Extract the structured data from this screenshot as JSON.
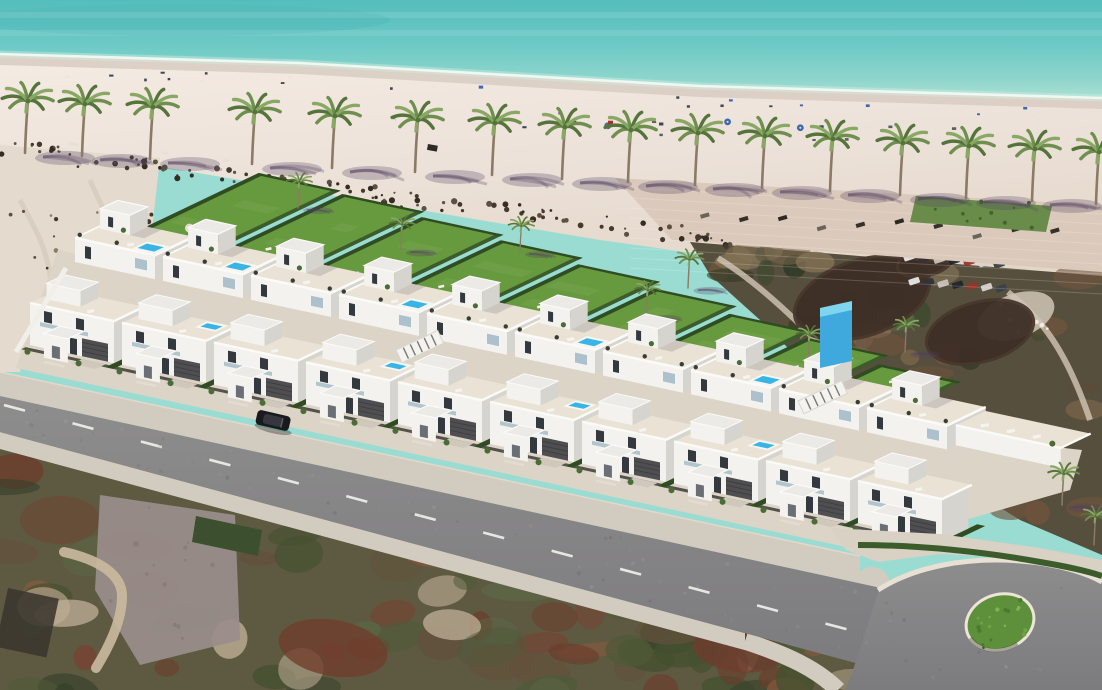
{
  "image": {
    "description": "Aerial 3D architectural rendering of a beachfront development: two rows of white modern villas with rooftop terraces and private garden pools, fronted by a palm-lined sandy beach and turquoise sea, with an asphalt road curving around a green traffic island below and undeveloped scrubland around",
    "width": 1102,
    "height": 690
  },
  "colors": {
    "sea_deep": "#55bdbc",
    "sea_mid": "#6cc9c5",
    "sea_shallow": "#8dd5cc",
    "sea_shore": "#abdfd3",
    "foam": "#f2f8f2",
    "foam_soft": "#cfeee3",
    "sand": "#ece1d8",
    "sand_light": "#f4ebe3",
    "sand_wet": "#d8cdc2",
    "sand_lot": "#e4dacd",
    "debris_dark": "#43392c",
    "debris_mid": "#5c5042",
    "debris_deep": "#352c22",
    "promenade": "#dbc9bc",
    "lawn_patch": "#6a8c4a",
    "lawn": "#67993f",
    "lawn_light": "#7aa953",
    "hedge": "#2f4c22",
    "hedge_light": "#3c5c2c",
    "pool": "#38b5e6",
    "pool_light": "#7fd4ee",
    "pool_rim": "#f6f6f3",
    "villa_white": "#f3f2ee",
    "villa_face2": "#eceae6",
    "villa_shade": "#d6d4cf",
    "terrace": "#e9e2d5",
    "parapet": "#fbfaf7",
    "window": "#34393f",
    "glass": "#9fb9c6",
    "garage": "#4f4f52",
    "fence": "#46443f",
    "blue_glass": "#3fa8dd",
    "road": "#868487",
    "road_line": "#efefec",
    "sidewalk": "#d2cbbf",
    "curb": "#e7e0d3",
    "apron": "#d8d1c4",
    "island_green": "#5e8f3a",
    "island_ring": "#ece5d8",
    "car": "#1a1a1e",
    "car_roof": "#36363e",
    "palm_leaf": "#6f8f4e",
    "palm_leaf_dark": "#55743b",
    "palm_leaf_light": "#8aa865",
    "palm_trunk": "#8a7a66",
    "shadow": "rgba(82,64,96,0.28)",
    "umbrella_blue": "#3f69ad",
    "speck_dark": "#3e4854",
    "speck_white": "#e8e6e0",
    "speck_red": "#a83428",
    "dirt_mauve": "#9a8e8c",
    "path_sand": "#c9b99d",
    "thatch": "#3e2f26",
    "thatch2": "#49372c",
    "dev_ground": "#dcd4c7",
    "wall_white": "#f1efe9",
    "shrub": "#4c6c35"
  },
  "sea": {
    "streaks_y": [
      12,
      30
    ],
    "dark_patch": {
      "cx": 180,
      "cy": 20,
      "rx": 210,
      "ry": 16
    }
  },
  "shoreline": {
    "points": [
      [
        0,
        54
      ],
      [
        300,
        63
      ],
      [
        700,
        86
      ],
      [
        1102,
        98
      ]
    ]
  },
  "beach": {
    "debris": {
      "x0": 0,
      "y0": 148,
      "x1": 730,
      "slope": 0.126,
      "count": 115
    },
    "lot_rock_count": 26,
    "furniture_band_a": {
      "count": 26,
      "offset": 16,
      "x0": 30,
      "x1": 1060
    },
    "furniture_band_b": {
      "count": 20,
      "offset": 42,
      "x0": 380,
      "x1": 1080
    },
    "red_item": {
      "x": 608,
      "offset": 40
    },
    "lifeguard": {
      "x": 428,
      "y": 144
    }
  },
  "palms": {
    "beach_row": [
      [
        25,
        153
      ],
      [
        82,
        156
      ],
      [
        150,
        159
      ],
      [
        252,
        164
      ],
      [
        332,
        168
      ],
      [
        415,
        172
      ],
      [
        492,
        175
      ],
      [
        562,
        179
      ],
      [
        628,
        182
      ],
      [
        695,
        185
      ],
      [
        762,
        188
      ],
      [
        830,
        191
      ],
      [
        900,
        195
      ],
      [
        966,
        198
      ],
      [
        1032,
        201
      ],
      [
        1096,
        204
      ]
    ],
    "dev_small": [
      [
        298,
        208,
        0.5
      ],
      [
        520,
        252,
        0.5
      ],
      [
        688,
        288,
        0.55
      ],
      [
        905,
        352,
        0.5
      ]
    ],
    "right_small": [
      [
        1062,
        505,
        0.6
      ],
      [
        1094,
        545,
        0.55
      ]
    ]
  },
  "development": {
    "ground_poly": [
      [
        58,
        250
      ],
      [
        884,
        428
      ],
      [
        1082,
        450
      ],
      [
        1070,
        490
      ],
      [
        860,
        550
      ],
      [
        16,
        368
      ]
    ],
    "back_row": {
      "x0": 75,
      "y0": 262,
      "spacing": 88,
      "count": 10,
      "unit_w": 80,
      "spas": [
        0,
        1,
        3,
        5,
        7
      ]
    },
    "front_row": {
      "x0": 30,
      "y0": 345,
      "spacing": 92,
      "count": 10,
      "unit_w": 84,
      "spas": [
        1,
        3,
        5,
        7
      ]
    },
    "garden_lengths": [
      165,
      160,
      150,
      140,
      128,
      115,
      100,
      88,
      70
    ],
    "garden_palm_units": [
      2,
      5,
      7
    ],
    "corner_terrace": {
      "unit": 9,
      "u0": 80,
      "u1": 185,
      "v0": 10,
      "v1": 44
    },
    "glass_tower": [
      [
        820,
        368
      ],
      [
        852,
        361
      ],
      [
        852,
        306
      ],
      [
        820,
        313
      ]
    ],
    "louver_bridges": [
      {
        "x": 396,
        "y": 350,
        "w": 46
      },
      {
        "x": 798,
        "y": 401,
        "w": 48
      }
    ],
    "left_wall": [
      [
        66,
        268
      ],
      [
        16,
        352
      ]
    ]
  },
  "road": {
    "top_y0": 372,
    "top_slope": 0.214,
    "asphalt_y0": 396,
    "asphalt_slope": 0.218,
    "bottom_y0": 432,
    "bottom_slope": 0.27,
    "sidewalk_w": 17,
    "end_x": 860,
    "center_y0": 404,
    "center_slope": 0.266,
    "dash_len": 21,
    "dash_gap": 25,
    "dash_end_x": 850,
    "bulb_path": "M880,588 C920,565 970,556 1020,560 C1065,563 1090,574 1102,582 L1102,690 L845,690 C860,655 868,620 880,588 Z",
    "curb_path": "M878,590 C915,566 968,557 1020,561 C1062,564 1090,575 1102,582",
    "lower_walk_curve": "M745,641 C790,656 818,670 838,690",
    "island": {
      "cx": 1000,
      "cy": 622,
      "rx": 33,
      "ry": 26,
      "rot": -18
    },
    "apron_poly": [
      [
        830,
        528
      ],
      [
        940,
        534
      ],
      [
        1040,
        548
      ],
      [
        1102,
        560
      ],
      [
        1102,
        580
      ],
      [
        1020,
        558
      ],
      [
        940,
        554
      ],
      [
        878,
        562
      ],
      [
        846,
        550
      ]
    ],
    "hedge_curve": "M858,545 C920,545 985,552 1040,562 C1070,567 1090,572 1102,576",
    "flecks": 80
  },
  "car": {
    "x": 273,
    "y": 421,
    "angle": 13
  },
  "terrain": {
    "bottom_poly": [
      [
        0,
        420
      ],
      [
        900,
        640
      ],
      [
        900,
        690
      ],
      [
        0,
        690
      ]
    ],
    "bottom_blob_count": 75,
    "bottom_palette": [
      "#4f5a39",
      "#63513c",
      "#7a4030",
      "#8a5a40",
      "#44502f",
      "#c2b098",
      "#5b6847",
      "#35402a",
      "#6d3b2b"
    ],
    "rust_patches": [
      {
        "cx": 333,
        "cy": 648,
        "rx": 55,
        "ry": 28,
        "rot": 10,
        "c": "#713c2c"
      },
      {
        "cx": 737,
        "cy": 650,
        "rx": 45,
        "ry": 22,
        "rot": 8,
        "c": "#6e3c2e"
      },
      {
        "cx": 60,
        "cy": 520,
        "rx": 40,
        "ry": 24,
        "rot": 0,
        "c": "#6a4a36"
      }
    ],
    "dirt_patch": [
      [
        100,
        495
      ],
      [
        235,
        515
      ],
      [
        240,
        640
      ],
      [
        140,
        665
      ],
      [
        95,
        590
      ]
    ],
    "sand_path": "M64,552 C100,560 122,575 122,596 C122,620 110,645 96,668",
    "dark_structure": {
      "x": 8,
      "y": 588,
      "w": 52,
      "h": 60,
      "rot": 12
    },
    "hedge_block": [
      [
        196,
        516
      ],
      [
        262,
        530
      ],
      [
        258,
        556
      ],
      [
        192,
        542
      ]
    ],
    "left_lot_poly": [
      [
        0,
        145
      ],
      [
        160,
        158
      ],
      [
        152,
        230
      ],
      [
        75,
        262
      ],
      [
        40,
        300
      ],
      [
        20,
        372
      ],
      [
        0,
        372
      ]
    ],
    "lot_tracks": [
      "M20,200 C40,240 60,260 50,360",
      "M90,180 C105,215 118,235 120,255"
    ],
    "right_scrub_poly": [
      [
        690,
        242
      ],
      [
        1102,
        276
      ],
      [
        1102,
        555
      ],
      [
        1020,
        520
      ],
      [
        940,
        470
      ],
      [
        880,
        430
      ],
      [
        820,
        380
      ],
      [
        760,
        320
      ],
      [
        710,
        275
      ]
    ],
    "right_blob_count": 48,
    "right_palette": [
      "#3e4a2e",
      "#566240",
      "#5f4a36",
      "#70543d",
      "#867458",
      "#2f3a26",
      "#776349"
    ],
    "right_paths": [
      "M718,258 C770,290 840,360 876,412 C895,438 908,455 918,470",
      "M1008,292 C1035,315 1062,338 1090,420"
    ],
    "courtyard": {
      "cx": 1016,
      "cy": 316,
      "rx": 40,
      "ry": 22,
      "rot": -20
    }
  },
  "promenade": {
    "poly": [
      [
        615,
        178
      ],
      [
        1102,
        205
      ],
      [
        1102,
        272
      ],
      [
        672,
        240
      ]
    ],
    "lounger_row": {
      "count": 10,
      "x0": 700,
      "x1": 1050,
      "y0": 214,
      "slope": 0.05
    }
  },
  "lawn_patch": {
    "poly": [
      [
        916,
        196
      ],
      [
        1052,
        206
      ],
      [
        1046,
        232
      ],
      [
        910,
        222
      ]
    ],
    "speck_count": 10
  },
  "thatch": [
    {
      "cx": 862,
      "cy": 298,
      "rx": 70,
      "ry": 38,
      "rot": -18
    },
    {
      "cx": 980,
      "cy": 332,
      "rx": 55,
      "ry": 30,
      "rot": -15
    },
    {
      "cx": 925,
      "cy": 262,
      "rx": 28,
      "ry": 14,
      "rot": -12
    }
  ],
  "parking": {
    "rows": [
      {
        "x": 903,
        "y": 256,
        "n": 7,
        "dx": 15,
        "dy": 1.2
      },
      {
        "x": 908,
        "y": 280,
        "n": 7,
        "dx": 14.5,
        "dy": 1.2
      }
    ],
    "car_colors": [
      "#e8e8e8",
      "#2f3338",
      "#c8c2b8",
      "#22262b",
      "#98342c",
      "#d8d4cc",
      "#3a4048"
    ]
  }
}
